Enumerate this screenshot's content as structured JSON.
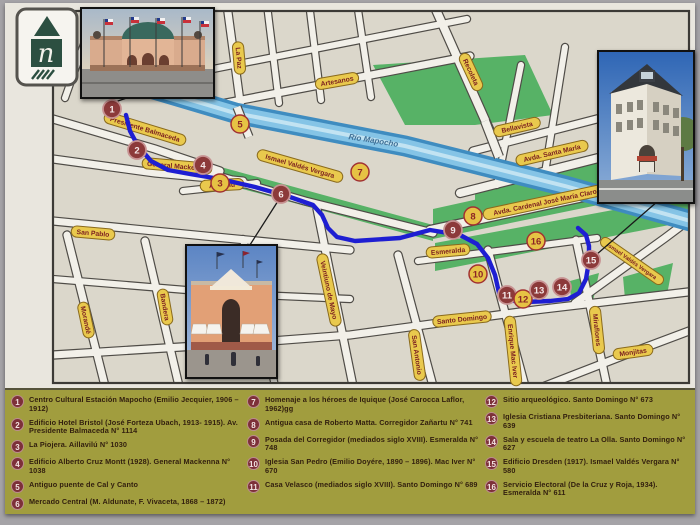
{
  "colors": {
    "paper": "#e9e6de",
    "block": "#dbd7cb",
    "street_fill": "#f2f0e9",
    "casing": "#4f4c47",
    "river_dark": "#3f8cc0",
    "river_light": "#85c4e6",
    "river_core": "#c2e3f2",
    "park": "#57b266",
    "pill_fill": "#e9c94d",
    "pill_stroke": "#8a6a1c",
    "pill_text": "#7c2020",
    "marker_red": "#8c3a3a",
    "marker_red_ring": "#c79292",
    "marker_yellow": "#e6c244",
    "marker_yellow_ring": "#a23232",
    "marker_yellow_text": "#8c2525",
    "route": "#1e1ed2",
    "connector": "#1a1a1a",
    "border": "#3c3a36",
    "water_text": "#3e6f96",
    "legend_bg": "#a19d3e"
  },
  "map": {
    "border": [
      48,
      8,
      636,
      372
    ],
    "parks": [
      [
        [
          368,
          62
        ],
        [
          520,
          52
        ],
        [
          548,
          112
        ],
        [
          470,
          122
        ],
        [
          400,
          122
        ]
      ],
      [
        [
          172,
          152
        ],
        [
          428,
          222
        ],
        [
          428,
          238
        ],
        [
          172,
          168
        ]
      ],
      [
        [
          428,
          206
        ],
        [
          700,
          146
        ],
        [
          700,
          180
        ],
        [
          428,
          236
        ]
      ],
      [
        [
          430,
          240
        ],
        [
          700,
          190
        ],
        [
          700,
          215
        ],
        [
          430,
          268
        ]
      ],
      [
        [
          470,
          182
        ],
        [
          700,
          138
        ],
        [
          700,
          158
        ],
        [
          470,
          200
        ]
      ],
      [
        [
          565,
          278
        ],
        [
          594,
          270
        ],
        [
          588,
          298
        ],
        [
          566,
          300
        ]
      ],
      [
        [
          618,
          274
        ],
        [
          668,
          260
        ],
        [
          662,
          292
        ],
        [
          620,
          296
        ]
      ]
    ],
    "streets": [
      {
        "pts": [
          [
            48,
            116
          ],
          [
            150,
            146
          ],
          [
            215,
            168
          ]
        ],
        "w": 7
      },
      {
        "pts": [
          [
            48,
            156
          ],
          [
            150,
            170
          ],
          [
            238,
            178
          ]
        ],
        "w": 7
      },
      {
        "pts": [
          [
            178,
            188
          ],
          [
            252,
            180
          ]
        ],
        "w": 6
      },
      {
        "pts": [
          [
            48,
            218
          ],
          [
            200,
            233
          ],
          [
            345,
            247
          ]
        ],
        "w": 7
      },
      {
        "pts": [
          [
            48,
            276
          ],
          [
            230,
            291
          ],
          [
            345,
            296
          ]
        ],
        "w": 6
      },
      {
        "pts": [
          [
            48,
            352
          ],
          [
            240,
            340
          ],
          [
            345,
            332
          ],
          [
            530,
            307
          ],
          [
            700,
            287
          ]
        ],
        "w": 7
      },
      {
        "pts": [
          [
            540,
            383
          ],
          [
            620,
            352
          ],
          [
            700,
            322
          ]
        ],
        "w": 7
      },
      {
        "pts": [
          [
            413,
            258
          ],
          [
            500,
            247
          ],
          [
            592,
            235
          ]
        ],
        "w": 6
      },
      {
        "pts": [
          [
            168,
            160
          ],
          [
            300,
            198
          ],
          [
            428,
            230
          ]
        ],
        "w": 7
      },
      {
        "pts": [
          [
            425,
            227
          ],
          [
            560,
            198
          ],
          [
            700,
            168
          ]
        ],
        "w": 8
      },
      {
        "pts": [
          [
            570,
            300
          ],
          [
            660,
            235
          ],
          [
            700,
            205
          ]
        ],
        "w": 7
      },
      {
        "pts": [
          [
            62,
            232
          ],
          [
            100,
            383
          ]
        ],
        "w": 7
      },
      {
        "pts": [
          [
            140,
            238
          ],
          [
            174,
            383
          ]
        ],
        "w": 7
      },
      {
        "pts": [
          [
            238,
            236
          ],
          [
            270,
            383
          ]
        ],
        "w": 6
      },
      {
        "pts": [
          [
            312,
            206
          ],
          [
            348,
            383
          ]
        ],
        "w": 7
      },
      {
        "pts": [
          [
            393,
            252
          ],
          [
            428,
            383
          ]
        ],
        "w": 7
      },
      {
        "pts": [
          [
            483,
            247
          ],
          [
            520,
            383
          ]
        ],
        "w": 7
      },
      {
        "pts": [
          [
            571,
            237
          ],
          [
            602,
            383
          ]
        ],
        "w": 7
      },
      {
        "pts": [
          [
            200,
            104
          ],
          [
            465,
            53
          ]
        ],
        "w": 7
      },
      {
        "pts": [
          [
            208,
            66
          ],
          [
            462,
            16
          ]
        ],
        "w": 6
      },
      {
        "pts": [
          [
            222,
            2
          ],
          [
            236,
            106
          ]
        ],
        "w": 7
      },
      {
        "pts": [
          [
            262,
            2
          ],
          [
            274,
            100
          ]
        ],
        "w": 6
      },
      {
        "pts": [
          [
            304,
            0
          ],
          [
            316,
            97
          ]
        ],
        "w": 6
      },
      {
        "pts": [
          [
            352,
            0
          ],
          [
            366,
            94
          ]
        ],
        "w": 6
      },
      {
        "pts": [
          [
            428,
            0
          ],
          [
            484,
            126
          ]
        ],
        "w": 8
      },
      {
        "pts": [
          [
            468,
            148
          ],
          [
            700,
            88
          ]
        ],
        "w": 7
      },
      {
        "pts": [
          [
            455,
            190
          ],
          [
            700,
            128
          ]
        ],
        "w": 8
      },
      {
        "pts": [
          [
            516,
            62
          ],
          [
            492,
            182
          ]
        ],
        "w": 6
      },
      {
        "pts": [
          [
            560,
            44
          ],
          [
            540,
            170
          ]
        ],
        "w": 6
      },
      {
        "pts": [
          [
            60,
            95
          ],
          [
            90,
            10
          ]
        ],
        "w": 6
      }
    ],
    "river": {
      "pts": [
        [
          95,
          70
        ],
        [
          230,
          110
        ],
        [
          400,
          143
        ],
        [
          560,
          183
        ],
        [
          700,
          222
        ]
      ]
    },
    "bridges": [
      {
        "pts": [
          [
            232,
            104
          ],
          [
            244,
            134
          ]
        ],
        "w": 7
      },
      {
        "pts": [
          [
            480,
            118
          ],
          [
            494,
            154
          ]
        ],
        "w": 8
      }
    ],
    "labels": [
      {
        "t": "Presidente Balmaceda",
        "x": 140,
        "y": 126,
        "r": 17
      },
      {
        "t": "General Mackenna",
        "x": 172,
        "y": 163,
        "r": 5
      },
      {
        "t": "Aillavilú",
        "x": 217,
        "y": 182,
        "r": -3
      },
      {
        "t": "San Pablo",
        "x": 88,
        "y": 230,
        "r": 5
      },
      {
        "t": "Artesanos",
        "x": 332,
        "y": 78,
        "r": -10
      },
      {
        "t": "La Paz",
        "x": 234,
        "y": 55,
        "r": 85
      },
      {
        "t": "Recoleta",
        "x": 466,
        "y": 69,
        "r": 65
      },
      {
        "t": "Ismael Valdés Vergara",
        "x": 295,
        "y": 163,
        "r": 16
      },
      {
        "t": "Bellavista",
        "x": 512,
        "y": 124,
        "r": -13
      },
      {
        "t": "Avda. Santa María",
        "x": 547,
        "y": 150,
        "r": -13
      },
      {
        "t": "Avda. Cardenal José María Claro",
        "x": 540,
        "y": 199,
        "r": -12
      },
      {
        "t": "Esmeralda",
        "x": 443,
        "y": 248,
        "r": -5
      },
      {
        "t": "Veintiuno de Mayo",
        "x": 324,
        "y": 287,
        "r": 78
      },
      {
        "t": "San Antonio",
        "x": 412,
        "y": 352,
        "r": 82
      },
      {
        "t": "Santo Domingo",
        "x": 457,
        "y": 316,
        "r": -6
      },
      {
        "t": "Enrique Mac Iver",
        "x": 508,
        "y": 348,
        "r": 84
      },
      {
        "t": "Miraflores",
        "x": 592,
        "y": 327,
        "r": 84
      },
      {
        "t": "Monjitas",
        "x": 628,
        "y": 349,
        "r": -8
      },
      {
        "t": "Morandé",
        "x": 81,
        "y": 317,
        "r": 78
      },
      {
        "t": "Bandera",
        "x": 160,
        "y": 304,
        "r": 80
      },
      {
        "t": "Ismael Valdés Vergara",
        "x": 627,
        "y": 258,
        "r": 35,
        "fs": 5.6
      }
    ],
    "water_label": {
      "t": "Río Mapocho",
      "x": 368,
      "y": 140,
      "r": 9
    },
    "route": [
      [
        121,
        112
      ],
      [
        125,
        128
      ],
      [
        133,
        143
      ],
      [
        146,
        158
      ],
      [
        163,
        167
      ],
      [
        185,
        171
      ],
      [
        215,
        176
      ],
      [
        250,
        184
      ],
      [
        285,
        194
      ],
      [
        308,
        202
      ],
      [
        317,
        212
      ],
      [
        323,
        225
      ],
      [
        332,
        234
      ],
      [
        350,
        238
      ],
      [
        395,
        235
      ],
      [
        425,
        227
      ],
      [
        455,
        232
      ],
      [
        472,
        241
      ],
      [
        483,
        255
      ],
      [
        490,
        272
      ],
      [
        494,
        290
      ],
      [
        500,
        297
      ],
      [
        520,
        299
      ],
      [
        545,
        298
      ],
      [
        563,
        296
      ],
      [
        574,
        290
      ],
      [
        581,
        276
      ],
      [
        584,
        258
      ],
      [
        584,
        243
      ],
      [
        581,
        232
      ],
      [
        573,
        225
      ]
    ],
    "connectors": [
      [
        110,
        99,
        142,
        88
      ],
      [
        273,
        198,
        243,
        245
      ],
      [
        591,
        252,
        653,
        198
      ]
    ],
    "markers": [
      {
        "n": "1",
        "x": 107,
        "y": 106,
        "s": "red"
      },
      {
        "n": "2",
        "x": 132,
        "y": 147,
        "s": "red"
      },
      {
        "n": "3",
        "x": 215,
        "y": 180,
        "s": "yellow"
      },
      {
        "n": "4",
        "x": 198,
        "y": 162,
        "s": "red"
      },
      {
        "n": "5",
        "x": 235,
        "y": 121,
        "s": "yellow"
      },
      {
        "n": "6",
        "x": 276,
        "y": 191,
        "s": "red"
      },
      {
        "n": "7",
        "x": 355,
        "y": 169,
        "s": "yellow"
      },
      {
        "n": "8",
        "x": 468,
        "y": 213,
        "s": "yellow"
      },
      {
        "n": "9",
        "x": 448,
        "y": 227,
        "s": "red"
      },
      {
        "n": "10",
        "x": 473,
        "y": 271,
        "s": "yellow"
      },
      {
        "n": "11",
        "x": 502,
        "y": 292,
        "s": "red"
      },
      {
        "n": "12",
        "x": 518,
        "y": 296,
        "s": "yellow"
      },
      {
        "n": "13",
        "x": 534,
        "y": 287,
        "s": "red"
      },
      {
        "n": "14",
        "x": 557,
        "y": 284,
        "s": "red"
      },
      {
        "n": "15",
        "x": 586,
        "y": 257,
        "s": "red"
      },
      {
        "n": "16",
        "x": 531,
        "y": 238,
        "s": "yellow"
      }
    ]
  },
  "logo": {
    "letter": "n"
  },
  "photos": [
    {
      "name": "estacion-mapocho-photo"
    },
    {
      "name": "edificio-dresden-photo"
    },
    {
      "name": "mercado-central-photo"
    }
  ],
  "legend": {
    "items": [
      {
        "n": "1",
        "text": "Centro Cultural Estación Mapocho (Emilio Jecquier, 1906 – 1912)"
      },
      {
        "n": "2",
        "text": "Edificio Hotel Bristol (José Forteza Ubach, 1913- 1915). Av. Presidente Balmaceda N° 1114"
      },
      {
        "n": "3",
        "text": "La Piojera. Aillavilú N° 1030"
      },
      {
        "n": "4",
        "text": "Edificio Alberto Cruz Montt (1928). General Mackenna N° 1038"
      },
      {
        "n": "5",
        "text": "Antiguo puente de Cal y Canto"
      },
      {
        "n": "6",
        "text": "Mercado Central (M. Aldunate, F. Vivaceta, 1868 – 1872)"
      },
      {
        "n": "7",
        "text": "Homenaje a los héroes de Iquique (José Carocca Laflor, 1962)gg"
      },
      {
        "n": "8",
        "text": "Antigua casa de Roberto Matta. Corregidor Zañartu N° 741"
      },
      {
        "n": "9",
        "text": "Posada del Corregidor (mediados siglo XVIII). Esmeralda N° 748"
      },
      {
        "n": "10",
        "text": "Iglesia San Pedro (Emilio Doyére, 1890 – 1896). Mac Iver N° 670"
      },
      {
        "n": "11",
        "text": "Casa Velasco (mediados siglo XVIII). Santo Domingo N° 689"
      },
      {
        "n": "12",
        "text": "Sitio arqueológico. Santo Domingo N° 673"
      },
      {
        "n": "13",
        "text": "Iglesia Cristiana Presbiteriana. Santo Domingo N° 639"
      },
      {
        "n": "14",
        "text": "Sala y escuela de teatro La Olla. Santo Domingo N° 627"
      },
      {
        "n": "15",
        "text": "Edificio Dresden (1917). Ismael Valdés Vergara N° 580"
      },
      {
        "n": "16",
        "text": "Servicio Electoral (De la Cruz y Roja, 1934). Esmeralda N° 611"
      }
    ],
    "columns": [
      [
        0,
        1,
        2,
        3,
        4,
        5
      ],
      [
        6,
        7,
        8,
        9,
        10
      ],
      [
        11,
        12,
        13,
        14,
        15
      ]
    ]
  }
}
